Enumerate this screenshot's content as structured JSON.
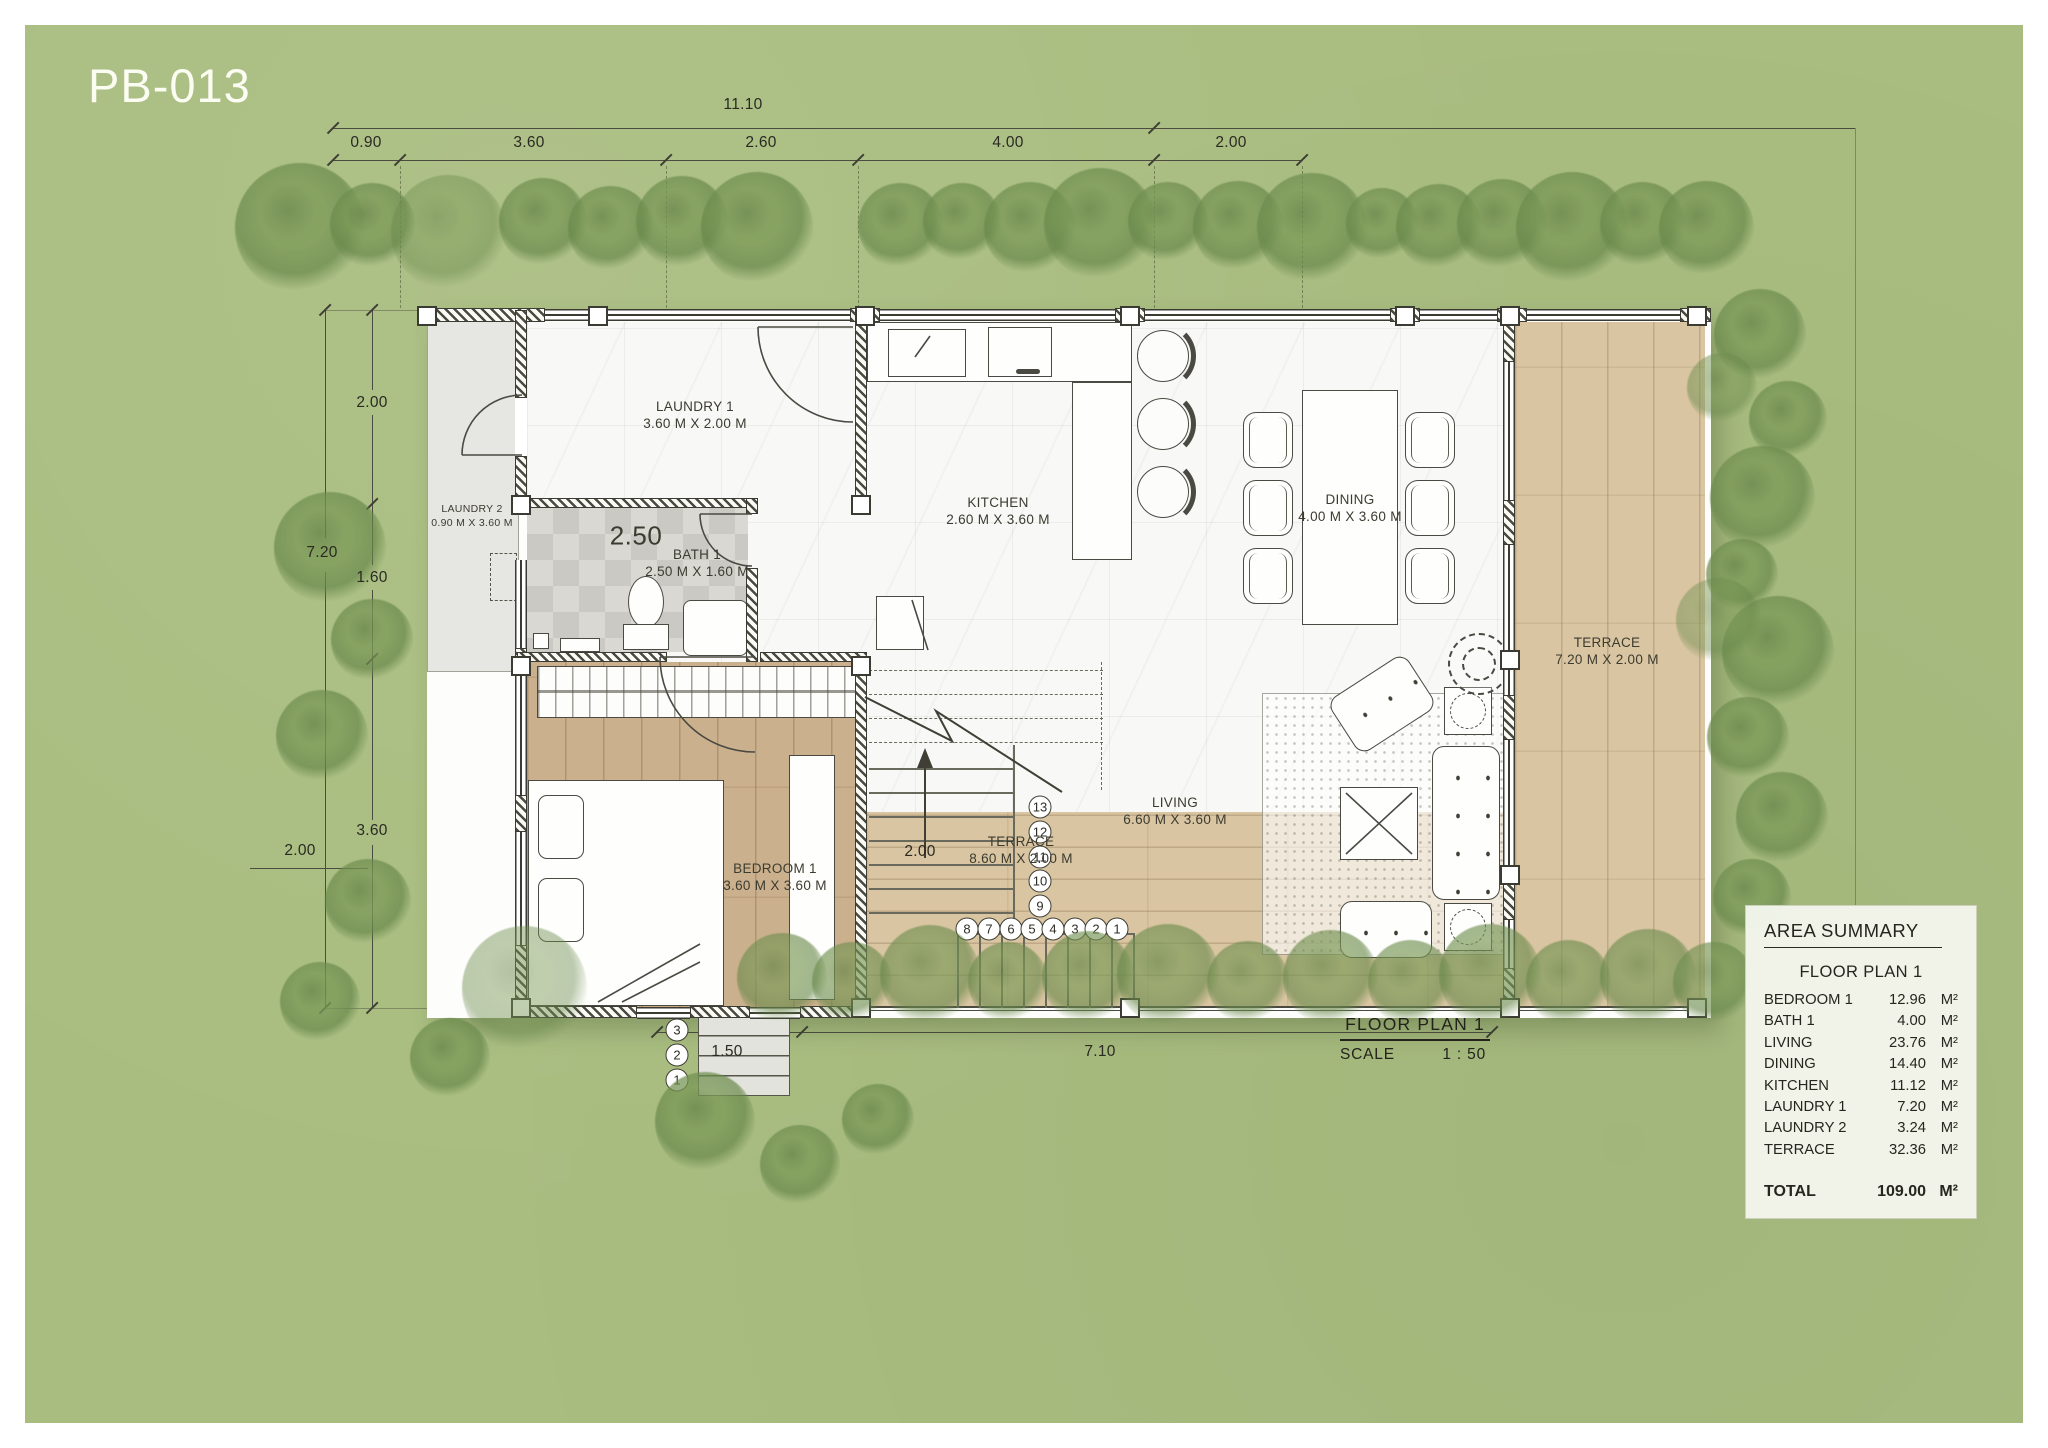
{
  "title": "PB-013",
  "dims": {
    "top_total": "11.10",
    "top": [
      "0.90",
      "3.60",
      "2.60",
      "4.00",
      "2.00"
    ],
    "left": [
      "2.00",
      "1.60",
      "3.60"
    ],
    "left_total": "7.20",
    "garden_left": "2.00",
    "bottom": [
      "1.50",
      "7.10"
    ],
    "terrace_width": "2.00"
  },
  "rooms": {
    "laundry1": {
      "name": "LAUNDRY 1",
      "size": "3.60 M X 2.00 M"
    },
    "laundry2": {
      "name": "LAUNDRY 2",
      "size": "0.90 M X 3.60 M"
    },
    "bath1": {
      "name": "BATH 1",
      "size": "2.50 M X 1.60 M",
      "width_label": "2.50"
    },
    "kitchen": {
      "name": "KITCHEN",
      "size": "2.60 M X 3.60 M"
    },
    "dining": {
      "name": "DINING",
      "size": "4.00 M X 3.60 M"
    },
    "living": {
      "name": "LIVING",
      "size": "6.60 M X 3.60 M"
    },
    "bedroom1": {
      "name": "BEDROOM 1",
      "size": "3.60 M X 3.60 M"
    },
    "terrace_side": {
      "name": "TERRACE",
      "size": "7.20 M X 2.00 M"
    },
    "terrace_bottom": {
      "name": "TERRACE",
      "size": "8.60 M X 2.00 M"
    }
  },
  "stairs": {
    "upper": [
      "13",
      "12",
      "11",
      "10",
      "9"
    ],
    "lower": [
      "8",
      "7",
      "6",
      "5",
      "4",
      "3",
      "2",
      "1"
    ],
    "entry": [
      "3",
      "2",
      "1"
    ]
  },
  "area_summary": {
    "title": "AREA SUMMARY",
    "subtitle": "FLOOR PLAN 1",
    "unit": "M²",
    "rows": [
      {
        "label": "BEDROOM 1",
        "value": "12.96"
      },
      {
        "label": "BATH 1",
        "value": "4.00"
      },
      {
        "label": "LIVING",
        "value": "23.76"
      },
      {
        "label": "DINING",
        "value": "14.40"
      },
      {
        "label": "KITCHEN",
        "value": "11.12"
      },
      {
        "label": "LAUNDRY 1",
        "value": "7.20"
      },
      {
        "label": "LAUNDRY 2",
        "value": "3.24"
      },
      {
        "label": "TERRACE",
        "value": "32.36"
      }
    ],
    "total_label": "TOTAL",
    "total_value": "109.00"
  },
  "footer": {
    "plan_name": "FLOOR PLAN 1",
    "scale_label": "SCALE",
    "scale_value": "1 : 50"
  },
  "colors": {
    "garden": "#a9bd80",
    "tree": "#6d9150",
    "wood_terrace": "#d9c5a2",
    "wood_bedroom": "#cbb08d",
    "marble": "#f8f8f6",
    "line": "#3b3b33",
    "panel_bg": "#f4f6ec"
  }
}
